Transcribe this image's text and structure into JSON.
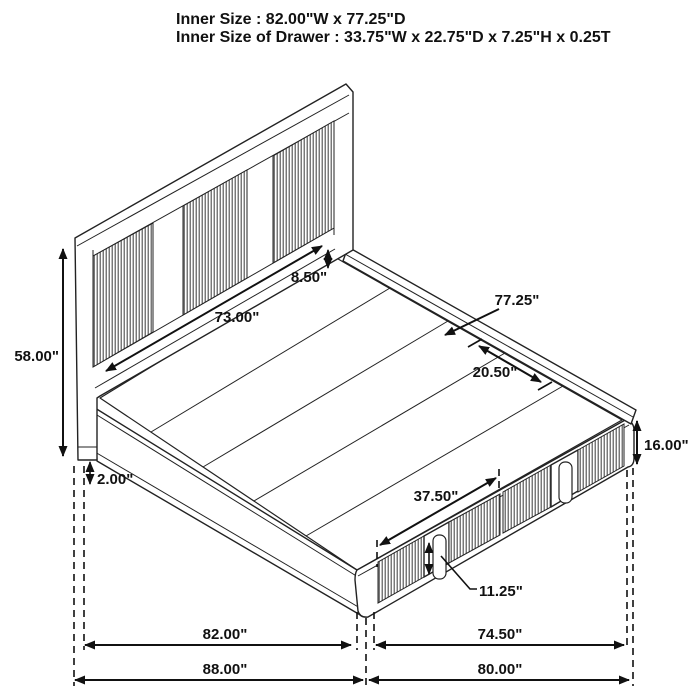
{
  "title": {
    "line1": "Inner Size : 82.00\"W x 77.25\"D",
    "line2": "Inner Size of Drawer : 33.75\"W x 22.75\"D x 7.25\"H x 0.25T"
  },
  "dimensions": {
    "headboard_height": "58.00\"",
    "frame_bottom_gap": "2.00\"",
    "headboard_inner_width": "73.00\"",
    "headboard_to_deck_gap": "8.50\"",
    "platform_depth": "77.25\"",
    "slat_gap": "20.50\"",
    "footboard_height": "16.00\"",
    "drawer_front_width": "37.50\"",
    "drawer_handle_height": "11.25\"",
    "side_inner_length": "82.00\"",
    "foot_inner_width": "74.50\"",
    "side_overall_length": "88.00\"",
    "foot_overall_width": "80.00\""
  }
}
